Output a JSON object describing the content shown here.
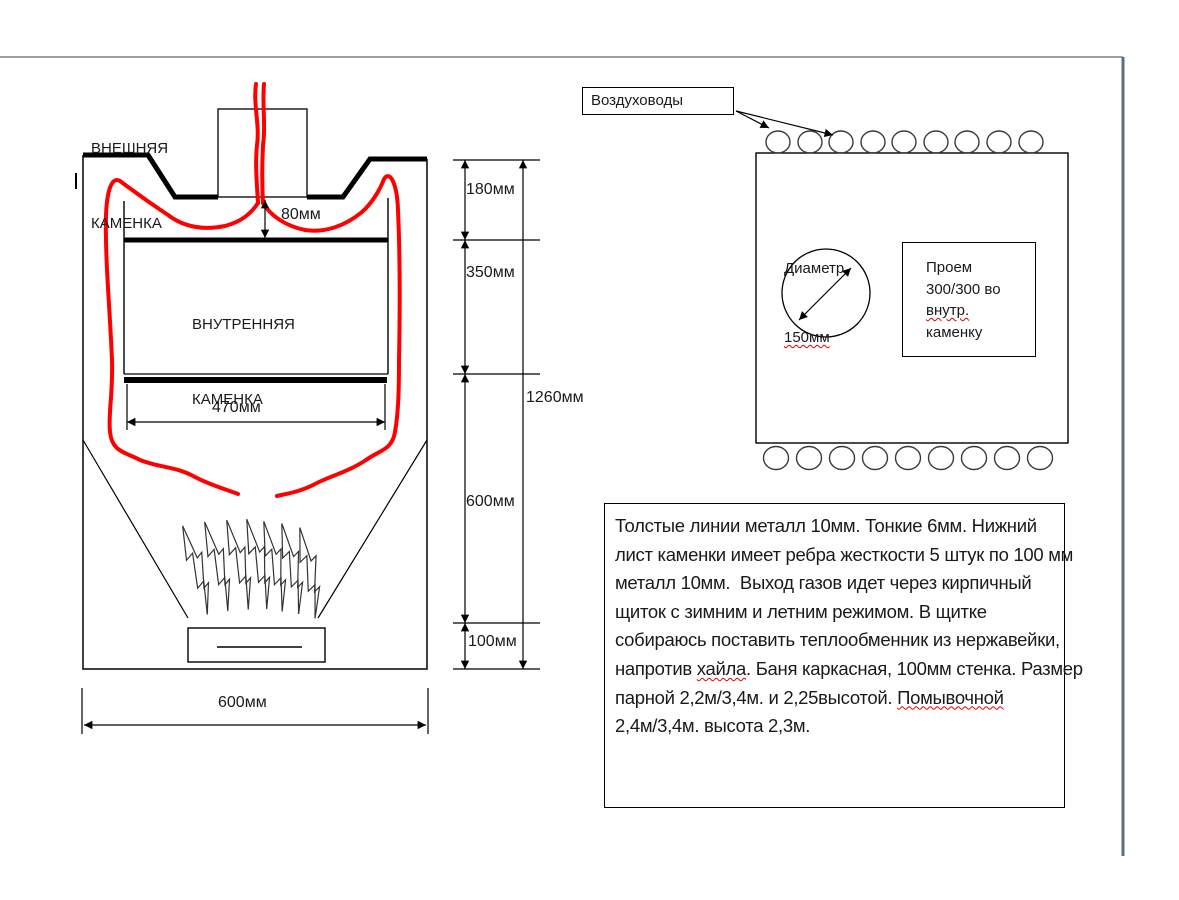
{
  "left_diagram": {
    "external_label_line1": "ВНЕШНЯЯ",
    "external_label_line2": "КАМЕНКА",
    "internal_label_line1": "ВНУТРЕННЯЯ",
    "internal_label_line2": "КАМЕНКА",
    "dim_gap": "80мм",
    "dim_inner_width": "470мм",
    "dim_seg1": "180мм",
    "dim_seg2": "350мм",
    "dim_seg3": "600мм",
    "dim_seg4": "100мм",
    "dim_total_height": "1260мм",
    "dim_outer_width": "600мм"
  },
  "right_diagram": {
    "air_ducts_label": "Воздуховоды",
    "diameter_line1": "Диаметр",
    "diameter_line2": "150мм",
    "opening_line1": "Проем",
    "opening_line2": "300/300 во",
    "opening_line3": "внутр.",
    "opening_line4": "каменку"
  },
  "notes": {
    "line1": "Толстые линии металл 10мм. Тонкие 6мм. Нижний",
    "line2": "лист каменки имеет ребра жесткости 5 штук по 100 мм",
    "line3": "металл 10мм.  Выход газов идет через кирпичный",
    "line4": "щиток с зимним и летним режимом. В щитке",
    "line5": "собираюсь поставить теплообменник из нержавейки,",
    "line6a": "напротив ",
    "line6b": "хайла",
    "line6c": ". Баня каркасная, 100мм стенка. Размер",
    "line7a": "парной 2,2м/3,4м. и 2,25высотой. ",
    "line7b": "Помывочной",
    "line8": "2,4м/3,4м. высота 2,3м."
  },
  "colors": {
    "flame_path_red": "#ff0000",
    "drawing_line": "#000000",
    "page_border_gray": "#7f7f7f",
    "page_border_slate": "#5e6d7c",
    "spellcheck_red": "#e00000"
  }
}
